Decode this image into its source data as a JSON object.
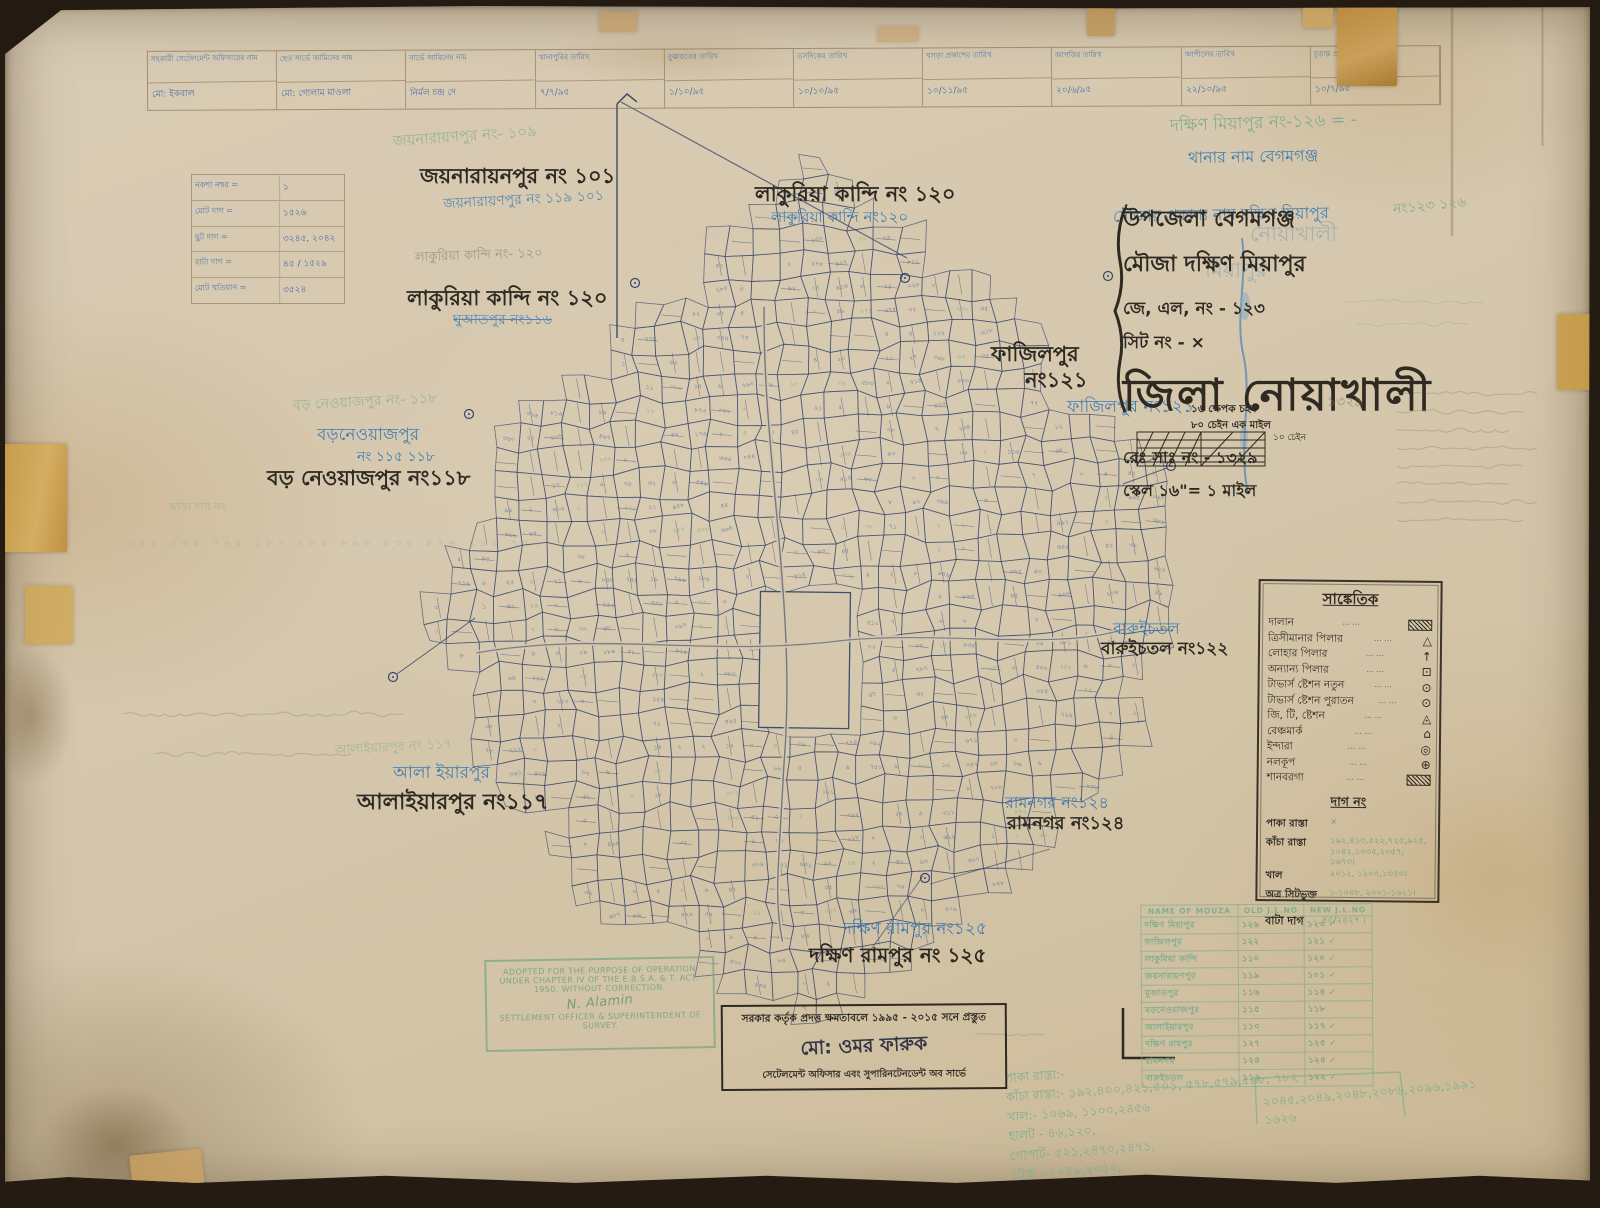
{
  "top_table": {
    "headers": [
      "সহকারী সেটেলমেন্ট অফিসারের নাম",
      "হেড সার্ভে আমিনের নাম",
      "সার্ভে আমিনের নাম",
      "খানাপুরির তারিখ",
      "বুঝারতের তারিখ",
      "তসদিকের তারিখ",
      "খসড়া প্রকাশের তারিখ",
      "আপত্তির তারিখ",
      "আপীলের তারিখ",
      "চূড়ান্ত প্রকাশের তারিখ"
    ],
    "values": [
      "মো: ইকবাল",
      "মো: গোলাম মাওলা",
      "নির্মল চন্দ্র দে",
      "৭/৭/৯৫",
      "১/১০/৯৫",
      "১০/১০/৯৫",
      "১০/১১/৯৫",
      "২০/৬/৯৫",
      "২২/১০/৯৫",
      "১০/৭/৯৫"
    ]
  },
  "corner_table": {
    "rows": [
      {
        "label": "নকশা নম্বর =",
        "value": "১"
      },
      {
        "label": "মোট দাগ =",
        "value": "১৫২৬"
      },
      {
        "label": "ছুট দাগ =",
        "value": "৩২৪৫, ২০৪২"
      },
      {
        "label": "বাটা দাগ =",
        "value": "৪৫ / ১৫২৯"
      },
      {
        "label": "মোট খতিয়ান =",
        "value": "৩৫২৪"
      }
    ]
  },
  "map_labels": {
    "jaynarayanpur_green": "জয়নারায়ণপুর নং- ১০৯",
    "jaynarayanpur_black": "জয়নারায়নপুর নং ১০১",
    "jaynarayanpur_blue": "জয়নারায়ণপুর নং ১১৯ ১০১",
    "lakuria_top_black": "লাকুরিয়া কান্দি নং ১২০",
    "lakuria_top_blue": "লাকুরিয়া কান্দি নং১২০",
    "lakuria_left_pencil": "লাকুরিয়া কান্দি নং- ১২০",
    "lakuria_left_black": "লাকুরিয়া কান্দি নং ১২০",
    "ghuatpur_blue_struck": "ঘুআতপুর নং১১৬",
    "boroneyaj_green": "বড় নেওয়াজপুর নং- ১১৮",
    "boroneyaj_blue1": "বড়নেওয়াজপুর",
    "boroneyaj_blue2": "নং ১১৫ ১১৮",
    "boroneyaj_black": "বড় নেওয়াজপুর নং১১৮",
    "chharadag_green": "ছাড়া দাগ নং",
    "chharadag_nums_green": "৩৪৫ ৩৬৪ ৭৬৫ ১৮৭ ২৮৫ ৬৬৬ ৪৩৫ ৪২৬ ৭৪৪ ৭৫২",
    "alaiyarpur_green": "আলাইয়ারপুর নং ১১৭",
    "alaiyarpur_blue": "আলা ইয়ারপুর",
    "alaiyarpur_black": "আলাইয়ারপুর নং১১৭",
    "fazilpur_black1": "ফাজিলপুর",
    "fazilpur_black2": "নং১২১",
    "fazilpur_blue": "ফাজিলপুর নং১২১",
    "baruichatal_blue": "বারুইচতল",
    "baruichatal_black": "বারুইচতল নং১২২",
    "ramnagar_blue": "রামনগর নং১২৪",
    "ramnagar_black": "রামনগর নং১২৪",
    "dakkhin_rampur_blue": "দক্ষিণ রামপুর নং১২৫",
    "dakkhin_rampur_black": "দক্ষিণ রামপুর নং ১২৫"
  },
  "title_block": {
    "green_top": "দক্ষিণ মিয়াপুর নং-১২৬ = -",
    "thana_blue": "থানার নাম বেগমগঞ্জ",
    "mouza_blue": "মৌজার প্রকাশ্য নাম দক্ষিণ মিয়াপুর",
    "green_no": "নং১২৩ ১২৬",
    "ghost1": "নোয়াখালী",
    "ghost2": "মিয়াপুর",
    "upazila": "উপজেলা বেগমগঞ্জ",
    "mouza": "মৌজা দক্ষিণ মিয়াপুর",
    "jl": "জে, এল, নং - ১২৩",
    "sheet": "সিট নং - ×",
    "district": "জিলা নোয়াখালী",
    "rs": "রেঃ সাঃ নং - ১৩২৯",
    "rs_pencil": "১৩২৯",
    "scale": "স্কেল ১৬\"= ১ মাইল"
  },
  "scale_notes": {
    "line1": "১৬ ক্ষেপক চইন",
    "line2": "৮০ চেইন এক মাইল",
    "bar_label": "১০ চেইন"
  },
  "legend": {
    "title": "সাঙ্কেতিক",
    "items": [
      {
        "label": "দালান",
        "glyph": "hatch"
      },
      {
        "label": "ত্রিসীমানার পিলার",
        "glyph": "△"
      },
      {
        "label": "লোহার পিলার",
        "glyph": "↑"
      },
      {
        "label": "অন্যান্য পিলার",
        "glyph": "⊡"
      },
      {
        "label": "টাভার্স ষ্টেশন নতুন",
        "glyph": "⊙"
      },
      {
        "label": "টাভার্স ষ্টেশন পুরাতন",
        "glyph": "⊙"
      },
      {
        "label": "জি, টি, ষ্টেশন",
        "glyph": "◬"
      },
      {
        "label": "বেঞ্চমার্ক",
        "glyph": "⌂"
      },
      {
        "label": "ইন্দারা",
        "glyph": "◎"
      },
      {
        "label": "নলকূপ",
        "glyph": "⊕"
      },
      {
        "label": "শানবরগা",
        "glyph": "hatch"
      }
    ],
    "dots": "···      ···"
  },
  "dag_box": {
    "title": "দাগ নং",
    "rows": [
      {
        "label": "পাকা রাস্তা",
        "value": "×"
      },
      {
        "label": "কাঁচা রাস্তা",
        "value": "১৯২,৪১৩,৫২২,৭২৫,৯২৫, ১০৪২,১৩৩৫,২০৫৭, ১৬৭৩।"
      },
      {
        "label": "খাল",
        "value": "২০১২, ১২০০,১৩৫৩।"
      },
      {
        "label": "অত্র সিটভুক্ত",
        "value": "১-১০৪৮, ২০০১-১৬২১।"
      }
    ],
    "bata_label": "বাটা দাগ",
    "bata_value": "৪৫/২৪২৭ ।"
  },
  "mouza_table": {
    "headers": [
      "NAME OF MOUZA",
      "OLD J.L.NO",
      "NEW J.L.NO"
    ],
    "rows": [
      [
        "দক্ষিণ মিয়াপুর",
        "১২৬",
        "১২৩ ✓"
      ],
      [
        "ফাজিলপুর",
        "১২২",
        "১২১ ✓"
      ],
      [
        "লাকুরিয়া কান্দি",
        "১১০",
        "১২০ ✓"
      ],
      [
        "জয়নারায়ণপুর",
        "১১৯",
        "১০১ ✓"
      ],
      [
        "মুজাতপুর",
        "১১৬",
        "১১৪ ✓"
      ],
      [
        "বড়নেওয়াজপুর",
        "১১৫",
        "১১৮"
      ],
      [
        "আলাইয়ারপুর",
        "১১০",
        "১১৭ ✓"
      ],
      [
        "দক্ষিণ রামপুর",
        "১২৭",
        "১২৫ ✓"
      ],
      [
        "রামনগর",
        "১২৪",
        "১২৪ ✓"
      ],
      [
        "বারুইচতল",
        "১১২",
        "১২২ ✓"
      ]
    ]
  },
  "stamp_box": {
    "line1": "সরকার কর্তৃক প্রদত্ত ক্ষমতাবলে ১৯৯৫ - ২০১৫ সনে প্রস্তুত",
    "name": "মো: ওমর ফারুক",
    "line2": "সেটেলমেন্ট অফিসার এবং সুপারিনটেনডেন্ট অব সার্ভে"
  },
  "green_stamp": {
    "line1": "ADOPTED FOR THE PURPOSE OF OPERATION",
    "line2": "UNDER CHAPTER IV OF THE E.B.S.A. & T. ACT,",
    "line3": "1950, WITHOUT CORRECTION.",
    "sig": "N. Alamin",
    "line4": "SETTLEMENT OFFICER & SUPERINTENDENT OF",
    "line5": "SURVEY."
  },
  "bottom_notes": {
    "lines": [
      "পাকা রাস্তা:-",
      "কাঁচা রাস্তা:-  ১৯২,৪০০,৪২১,৫০১, ৫৭৮,৫৭৯,৫৯৮, ৭৮২",
      "খাল:- ১০৬৯, ১১০০,২৪৫৬",
      "হালট - ৪৬,১২০,",
      "গোপাট- ৫২১,২৪৭০,২৪৭১,",
      "ট্রেঞ্চ - ২০৪৯,২০৫০,",
      "বাট = ৪৫ / ২৪২৭",
      "মোট - ২৪২৯"
    ],
    "side": [
      "২০৪৫,২০৪৯,২০৪৮,২০৮৬,২০৯৬,১৯৯১",
      "১৬২৬"
    ]
  }
}
